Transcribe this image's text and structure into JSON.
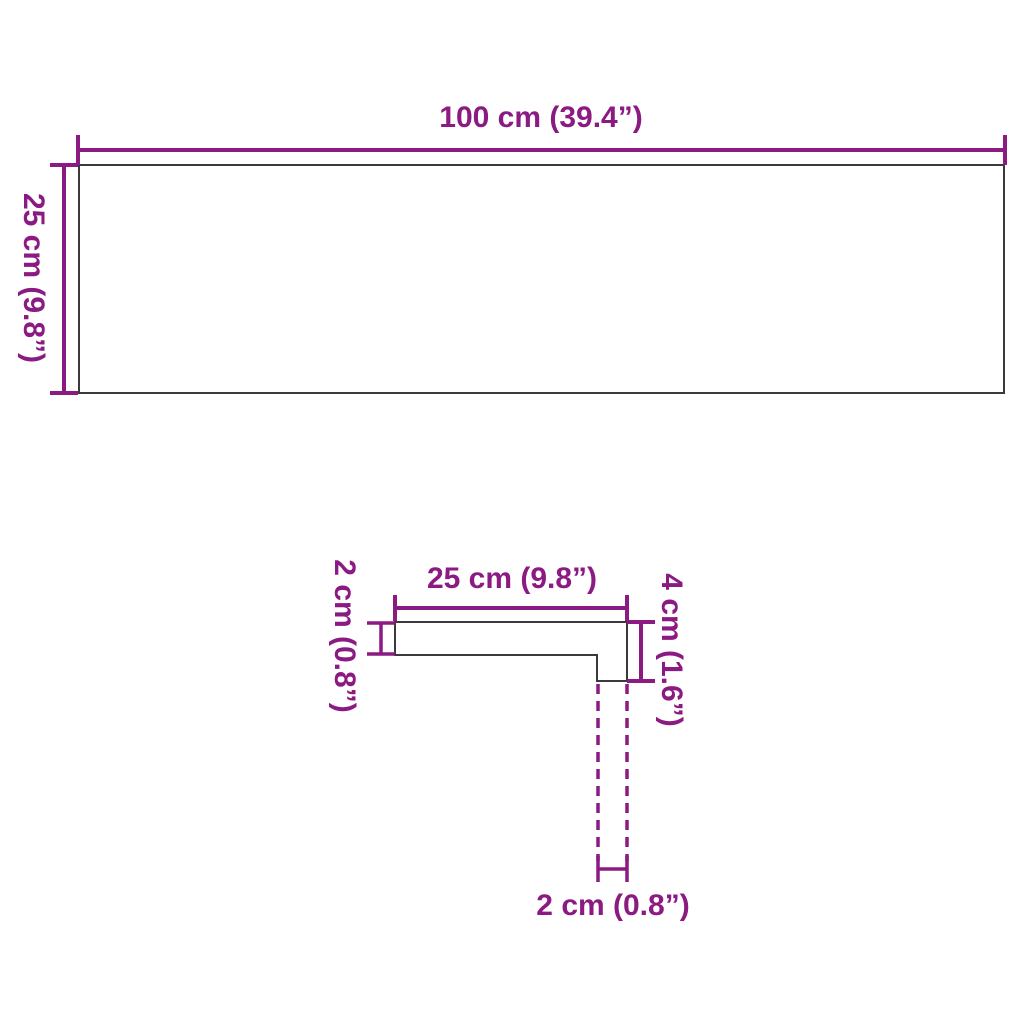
{
  "diagram": {
    "kind": "product-dimensions-technical-drawing",
    "views": {
      "top_view": "rectangular board 100 x 25 cm",
      "side_view": "L-shaped stair tread profile with dashed hidden riser edges"
    }
  },
  "colors": {
    "dimension_color": "#8B1A82",
    "outline_color": "#3A3A3A",
    "background_color": "#FFFFFF"
  },
  "measurements": {
    "board_width": {
      "value_cm": 100,
      "value_in": 39.4,
      "label": "100 cm (39.4”)"
    },
    "board_depth": {
      "value_cm": 25,
      "value_in": 9.8,
      "label": "25 cm (9.8”)"
    },
    "profile_width": {
      "value_cm": 25,
      "value_in": 9.8,
      "label": "25 cm (9.8”)"
    },
    "profile_thickness": {
      "value_cm": 2,
      "value_in": 0.8,
      "label": "2 cm (0.8”)"
    },
    "profile_height": {
      "value_cm": 4,
      "value_in": 1.6,
      "label": "4 cm (1.6”)"
    },
    "profile_leg_width": {
      "value_cm": 2,
      "value_in": 0.8,
      "label": "2 cm (0.8”)"
    }
  }
}
